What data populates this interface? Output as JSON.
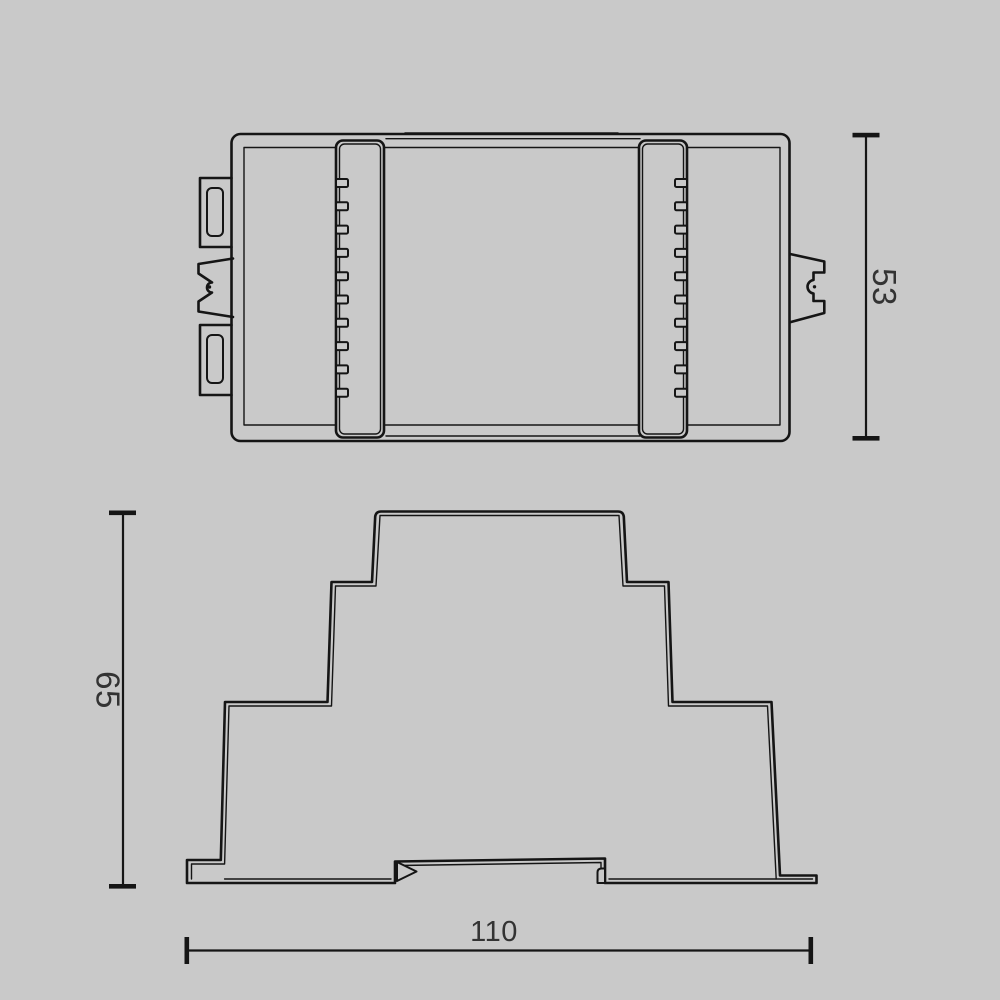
{
  "page": {
    "background_color": "#c9c9c9",
    "line_color": "#151515",
    "text_color": "#333333"
  },
  "dimensions": {
    "top_view_height": {
      "value": "53",
      "orientation": "vertical"
    },
    "front_view_height": {
      "value": "65",
      "orientation": "vertical"
    },
    "front_view_width": {
      "value": "110",
      "orientation": "horizontal"
    }
  }
}
